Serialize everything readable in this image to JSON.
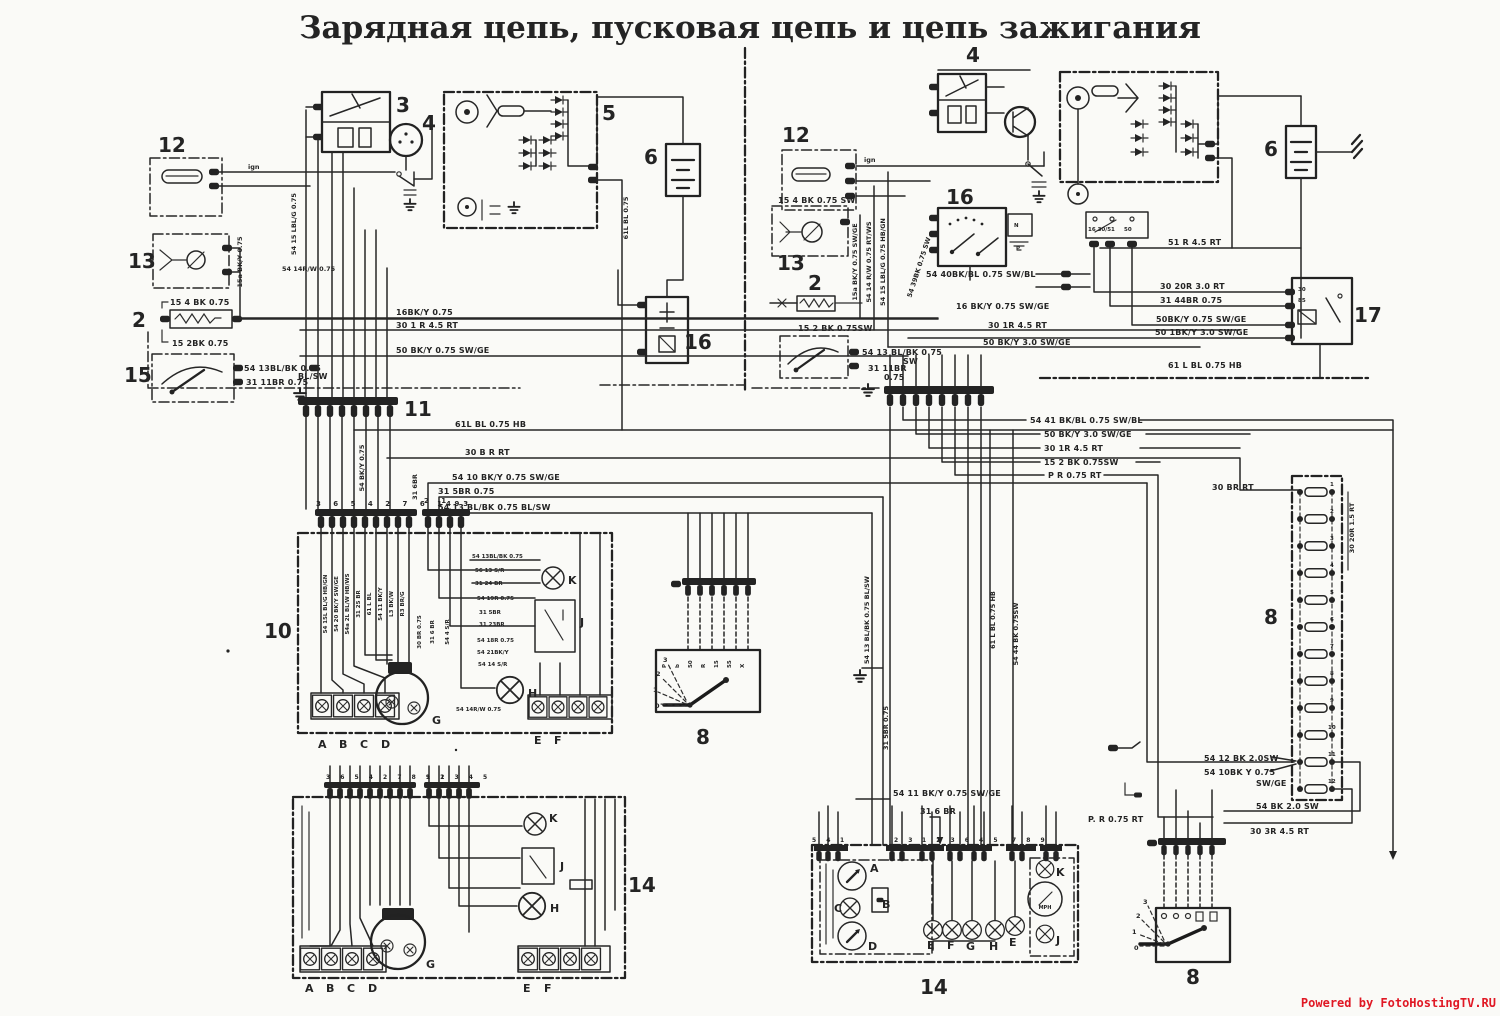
{
  "title": "Зарядная цепь, пусковая цепь и цепь зажигания",
  "watermark": "Powered by FotoHostingTV.RU",
  "colors": {
    "ink": "#242424",
    "paper": "#fafaf7",
    "watermark_red": "#e01824"
  },
  "left": {
    "comp": {
      "c12": "12",
      "c13": "13",
      "c2": "2",
      "c15": "15",
      "c3": "3",
      "c4": "4",
      "c5": "5",
      "c6": "6",
      "c16": "16",
      "c11": "11",
      "c10": "10",
      "c14": "14",
      "c8": "8"
    },
    "wire": {
      "ign": "ign",
      "b15_4": "15 4 BK 0.75",
      "b15_2": "15 2BK 0.75",
      "s54_13": "54 13BL/BK 0.75",
      "blsw": "BL/SW",
      "b31_11": "31 11BR 0.75",
      "v15a": "15a BK/Y 0.75",
      "v54_15": "54 15 LBL/G 0.75",
      "h54_14": "54 14R/W 0.75",
      "v61": "61L BL 0.75",
      "h16bk": "16BK/Y 0.75",
      "h30_1": "30 1 R 4.5 RT",
      "h50bk": "50 BK/Y 0.75 SW/GE",
      "bus61": "61L BL 0.75 HB",
      "bus30": "30 B R RT",
      "bus54_10": "54 10 BK/Y 0.75 SW/GE",
      "bus31_5": "31 5BR 0.75",
      "bus54_13": "54 13 BL/BK 0.75 BL/SW",
      "v54bky": "54 BK/Y 0.75",
      "v31_6": "31 6BR"
    },
    "c10": {
      "pins_a": "3 6 5 4 2 7 6 1 9",
      "pins_b": "2 1",
      "pins_c": "4 3",
      "w1": "54 13BL/BK 0.75",
      "w2": "56 13 S/R",
      "w3": "31 24 BR",
      "w4": "54 19R 0.75",
      "w5": "31 5BR",
      "w6": "31 23BR",
      "w7": "54 18R 0.75",
      "w8": "54 21BK/Y",
      "w9": "54 14 S/R",
      "w10": "54 14R/W 0.75",
      "v1": "54 15L BL/G HB/GN",
      "v2": "54 20 BK/Y SW/GE",
      "v3": "54a 2L BL/W HB/WS",
      "v4": "31 25 BR",
      "v5": "61 L BL",
      "v6": "54 11 BK/Y",
      "v7": "L3 BK/W",
      "v8": "R3 BR/G",
      "m1": "30 BR 0.75",
      "m2": "31 6 BR",
      "m3": "54 4 S/R",
      "K": "K",
      "J": "J",
      "H": "H",
      "G": "G",
      "tA": "A",
      "tB": "B",
      "tC": "C",
      "tD": "D",
      "tE": "E",
      "tF": "F"
    },
    "c14": {
      "pins_a": "3 6 5 4 2 7 8 9 1",
      "pins_b": "1 2 3 4 5",
      "K": "K",
      "J": "J",
      "H": "H",
      "G": "G",
      "tA": "A",
      "tB": "B",
      "tC": "C",
      "tD": "D",
      "tE": "E",
      "tF": "F"
    },
    "sw8": {
      "p3": "3",
      "p2": "2",
      "p1": "1",
      "p0": "0",
      "t1": "P",
      "t2": "b",
      "t3": "50",
      "t4": "R",
      "t5": "15",
      "t6": "55",
      "t7": "X"
    }
  },
  "right": {
    "comp": {
      "c12": "12",
      "c13": "13",
      "c2": "2",
      "c4": "4",
      "c16": "16",
      "c6": "6",
      "c17": "17",
      "c8f": "8",
      "c14": "14",
      "c8s": "8"
    },
    "wire": {
      "ign": "ign",
      "b15_4": "15 4 BK 0.75 SW",
      "b15_2": "15 2 BK 0.75SW",
      "s54_13": "54 13 BL/BK 0.75",
      "sw": "SW",
      "b31_11": "31 11BR",
      "b075": "0.75",
      "v15a": "15a BK/Y 0.75 SW/GE",
      "v54_14": "54 14 R/W 0.75 RT/WS",
      "v54_15": "54 15 LBL/G 0.75 HB/GN",
      "v54_39": "54 39BK 0.75 SW",
      "h54_40": "54 40BK/BL 0.75 SW/BL",
      "h16bk": "16 BK/Y 0.75 SW/GE",
      "h30_1": "30 1R 4.5 RT",
      "h50bk3": "50 BK/Y 3.0 SW/GE",
      "h51r": "51 R 4.5 RT",
      "h30_20": "30 20R 3.0 RT",
      "h31_44": "31 44BR 0.75",
      "h50_075": "50BK/Y 0.75 SW/GE",
      "h50_130": "50 1BK/Y 3.0 SW/GE",
      "h61": "61 L BL 0.75 HB",
      "h54_41": "54 41 BK/BL 0.75 SW/BL",
      "h50bk3b": "50 BK/Y 3.0 SW/GE",
      "h30_1b": "30 1R 4.5 RT",
      "h15_2": "15 2 BK 0.75SW",
      "hpr": "P R 0.75 RT",
      "h30br": "30 BR RT",
      "v30_20": "30 20R 1.5 RT",
      "h54_12": "54 12 BK 2.0SW",
      "h54_10": "54 10BK Y 0.75",
      "swge": "SW/GE",
      "hpr2": "P. R 0.75 RT",
      "h54bk": "54 BK 2.0 SW",
      "h30_3": "30 3R 4.5 RT",
      "v54_13": "54 13 BL/BK 0.75 BL/SW",
      "v31_5": "31 5BR 0.75",
      "v61": "61 L BL 0.75 HB",
      "v54_44": "54 44 BK 0.75SW",
      "h54_11": "54 11 BK/Y 0.75 SW/GE",
      "h31_6": "31 6 BR"
    },
    "starter": {
      "t1": "16 30/51",
      "t2": "50"
    },
    "c16": {
      "tN": "N",
      "tP": "P"
    },
    "c17": {
      "t30": "30",
      "t85": "85"
    },
    "fuse": {
      "pins": [
        "1",
        "2",
        "3",
        "4",
        "5",
        "6",
        "7",
        "8",
        "9",
        "10",
        "11",
        "12"
      ]
    },
    "c14": {
      "p1": "5 4",
      "p2": "1",
      "p3": "2 3",
      "p4": "1 2 3 6 4 5",
      "p5": "7 8 9",
      "A": "A",
      "B": "B",
      "C": "C",
      "D": "D",
      "E1": "E",
      "F1": "F",
      "G": "G",
      "H": "H",
      "E2": "E",
      "K": "K",
      "J": "J",
      "mph": "MPH"
    },
    "sw8": {
      "p3": "3",
      "p2": "2",
      "p1": "1",
      "p0": "0"
    }
  }
}
